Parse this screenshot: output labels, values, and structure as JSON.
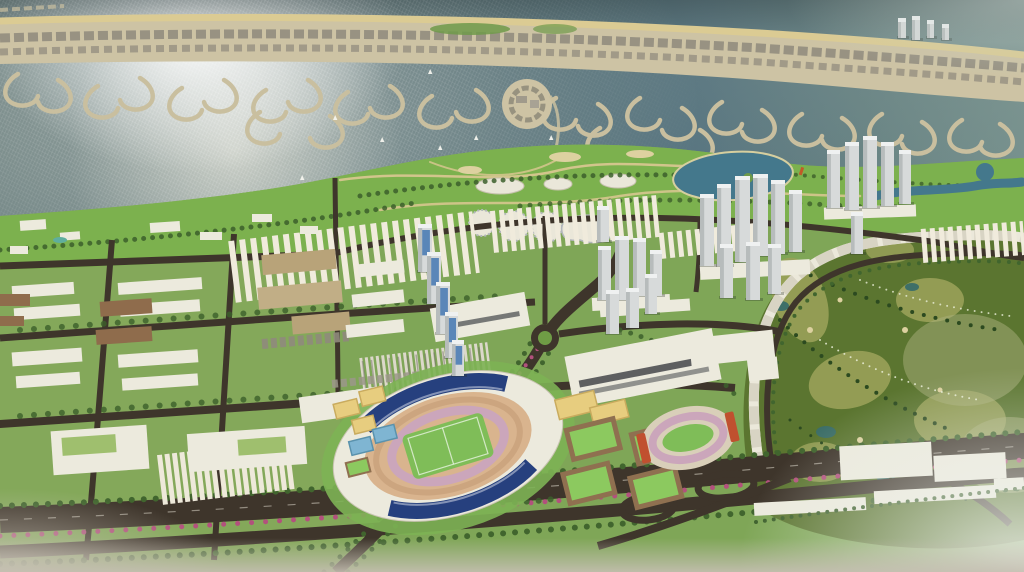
{
  "scene": {
    "title": "Aerial 3D rendering of a coastal city master plan with barrier-island marinas, waterfront park, high-rise clusters, main stadium, sports fields and a golf course",
    "type": "architectural-visualization",
    "no_visible_text": true,
    "landmarks": [
      "sun-glint-water",
      "barrier-island",
      "marina-fingers",
      "circular-marina-island",
      "coastal-park",
      "dome-pavilions",
      "park-lake",
      "golf-course",
      "golf-villas-arc",
      "main-stadium",
      "athletics-track",
      "practice-fields",
      "tennis-courts",
      "tower-cluster-a",
      "tower-cluster-b",
      "tower-cluster-c",
      "blue-glass-towers",
      "residential-blocks",
      "terrace-row-housing",
      "parking-lot",
      "canopy-parking",
      "main-boulevard",
      "diagonal-avenue",
      "roundabout",
      "highway-interchange"
    ],
    "counts": {
      "tower_clusters": 3,
      "dome_pavilions": 4,
      "stadiums": 1,
      "running_tracks": 1,
      "roundabouts": 1,
      "sailboats": 7
    },
    "palette": {
      "water_deep": "#4e666d",
      "water_mid": "#5d7a80",
      "water_far": "#7d928e",
      "glint": "#f4f2ea",
      "sand": "#cdc3a4",
      "beach": "#dbcb93",
      "island_rows": "#8e897c",
      "marina": "#c9bf9f",
      "land": "#7fa657",
      "park": "#7cb14e",
      "park_path": "#dcc893",
      "tree": "#3c5f2b",
      "tree_row": "#41652e",
      "flower": "#b2517d",
      "lake": "#44788c",
      "pond": "#3e6f68",
      "bunker": "#ddd1a0",
      "golf": "#5b7530",
      "golf_olive": "#99a159",
      "golf_pale": "#aab07c",
      "road": "#3e352b",
      "median": "#6f9c45",
      "building": "#eceadd",
      "dome": "#eae7d9",
      "ribbon": "#45474a",
      "tower": "#d7dada",
      "tower_shade": "#b7bcbc",
      "tower_top": "#eff1f1",
      "glass": "#4f7fb5",
      "brown": "#8f6c4c",
      "tan_block": "#b8a379",
      "warm_block": "#c1ae86",
      "stadium_roof": "#26407e",
      "bowl": "#d9b48e",
      "track": "#cba6bb",
      "pitch": "#7fbd58",
      "court_yellow": "#e7cd7f",
      "court_blue": "#7fb5d2",
      "field": "#8cc95f",
      "field_border": "#8f7050",
      "stand": "#c0502f",
      "haze": "#e7eae6"
    },
    "towers": {
      "blue": [
        [
          418,
          226,
          14,
          46
        ],
        [
          427,
          254,
          14,
          50
        ],
        [
          436,
          284,
          14,
          50
        ],
        [
          445,
          314,
          13,
          44
        ],
        [
          452,
          342,
          12,
          34
        ]
      ],
      "clusterA": [
        [
          597,
          208,
          12,
          34
        ],
        [
          598,
          248,
          13,
          52
        ],
        [
          615,
          238,
          14,
          62
        ],
        [
          633,
          240,
          13,
          56
        ],
        [
          650,
          252,
          12,
          44
        ],
        [
          606,
          292,
          13,
          42
        ],
        [
          626,
          290,
          13,
          38
        ],
        [
          645,
          276,
          12,
          38
        ]
      ],
      "clusterB": [
        [
          700,
          196,
          14,
          70
        ],
        [
          717,
          186,
          14,
          80
        ],
        [
          735,
          178,
          15,
          84
        ],
        [
          753,
          176,
          15,
          80
        ],
        [
          771,
          182,
          14,
          72
        ],
        [
          789,
          192,
          13,
          60
        ],
        [
          720,
          246,
          13,
          52
        ],
        [
          746,
          244,
          14,
          56
        ],
        [
          768,
          246,
          13,
          48
        ]
      ],
      "clusterC": [
        [
          827,
          152,
          13,
          56
        ],
        [
          845,
          144,
          14,
          66
        ],
        [
          863,
          138,
          14,
          70
        ],
        [
          881,
          144,
          13,
          62
        ],
        [
          899,
          152,
          12,
          52
        ],
        [
          851,
          214,
          12,
          40
        ]
      ],
      "island": [
        [
          898,
          20,
          8,
          18
        ],
        [
          912,
          18,
          8,
          22
        ],
        [
          927,
          22,
          7,
          16
        ],
        [
          942,
          26,
          7,
          14
        ]
      ]
    },
    "marinas": [
      [
        18,
        74,
        1
      ],
      [
        58,
        80,
        -1
      ],
      [
        98,
        86,
        1
      ],
      [
        140,
        78,
        -1
      ],
      [
        182,
        88,
        1
      ],
      [
        224,
        80,
        -1
      ],
      [
        266,
        90,
        1
      ],
      [
        308,
        80,
        -1
      ],
      [
        348,
        92,
        1
      ],
      [
        390,
        86,
        -1
      ],
      [
        432,
        96,
        1
      ],
      [
        476,
        90,
        -1
      ],
      [
        556,
        98,
        1
      ],
      [
        598,
        104,
        -1
      ],
      [
        640,
        98,
        1
      ],
      [
        682,
        108,
        -1
      ],
      [
        722,
        102,
        1
      ],
      [
        762,
        110,
        -1
      ],
      [
        802,
        114,
        1
      ],
      [
        842,
        118,
        -1
      ],
      [
        882,
        114,
        1
      ],
      [
        922,
        122,
        -1
      ],
      [
        962,
        120,
        1
      ],
      [
        1000,
        124,
        -1
      ],
      [
        260,
        112,
        1
      ],
      [
        330,
        116,
        -1
      ],
      [
        600,
        128,
        1
      ],
      [
        700,
        130,
        -1
      ]
    ],
    "boats": [
      [
        333,
        120
      ],
      [
        428,
        74
      ],
      [
        438,
        150
      ],
      [
        474,
        140
      ],
      [
        549,
        140
      ],
      [
        300,
        180
      ],
      [
        380,
        142
      ]
    ]
  }
}
